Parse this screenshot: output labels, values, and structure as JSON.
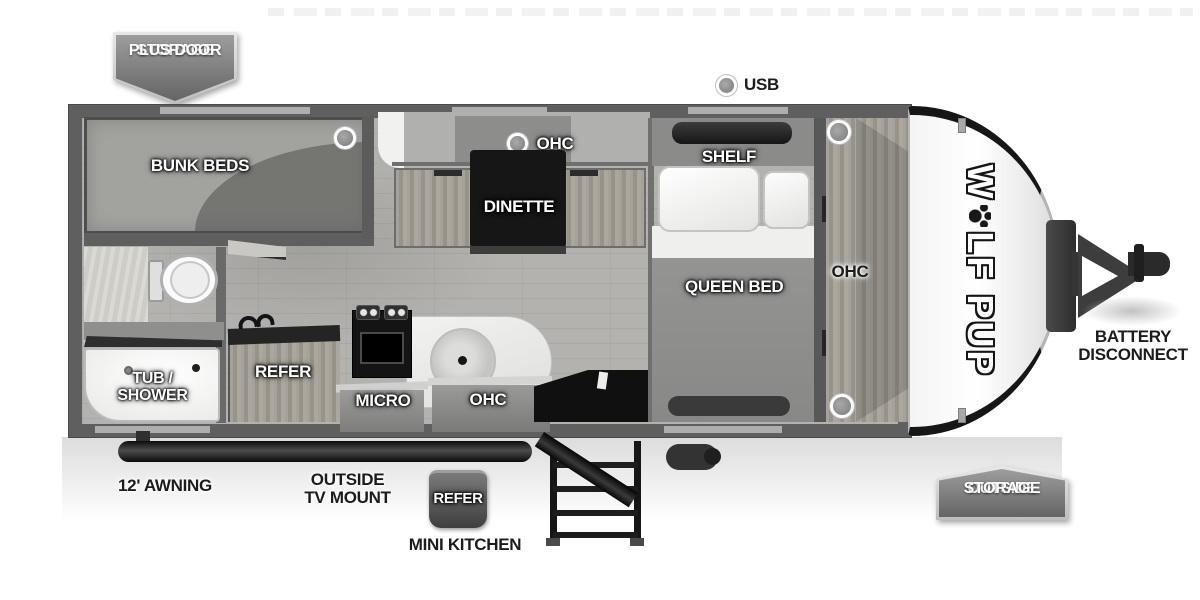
{
  "badges": {
    "storage_plus_door": [
      "STORAGE",
      "PLUS DOOR"
    ],
    "outside_storage": [
      "OUTSIDE",
      "STORAGE"
    ]
  },
  "exterior_callouts": {
    "usb": "USB",
    "battery_disconnect": [
      "BATTERY",
      "DISCONNECT"
    ],
    "awning": "12' AWNING",
    "outside_tv_mount": [
      "OUTSIDE",
      "TV MOUNT"
    ],
    "outside_refer": "REFER",
    "mini_kitchen": "MINI KITCHEN"
  },
  "interior_labels": {
    "bunk_beds": "BUNK BEDS",
    "dinette": "DINETTE",
    "dinette_ohc": "OHC",
    "shelf": "SHELF",
    "queen_bed": "QUEEN BED",
    "front_ohc": "OHC",
    "tub_shower": [
      "TUB /",
      "SHOWER"
    ],
    "refer": "REFER",
    "micro": "MICRO",
    "kitchen_ohc": "OHC"
  },
  "logo": {
    "brand_prefix": "W",
    "brand_suffix": "LF PUP",
    "paw_icon": "paw-print-icon"
  },
  "icons": {
    "usb_indicator": "circle-marker",
    "ceiling_light_markers": "circle-marker"
  },
  "colors": {
    "wall": "#5f5f5f",
    "floor": "#b4b2ae",
    "dinette_table": "#161616",
    "label_light": "#ffffff",
    "label_dark": "#1c1c1c",
    "badge_gradient_top": "#9d9d9d",
    "badge_gradient_bottom": "#646464"
  }
}
